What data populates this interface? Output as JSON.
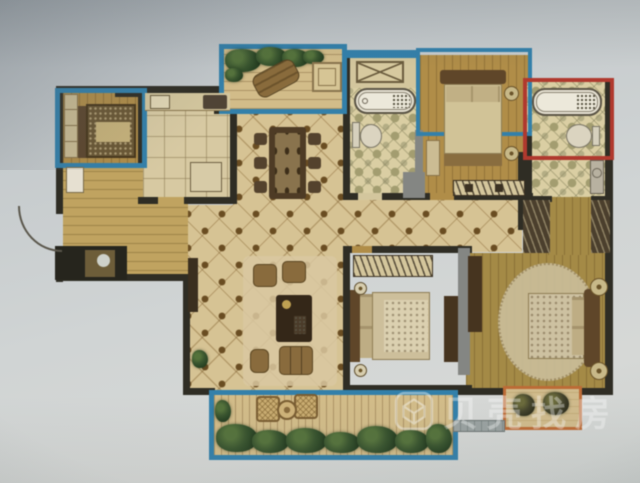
{
  "image": {
    "kind": "photograph of a printed apartment floor plan",
    "orientation": "plan occupies upper-right area of grey photo background"
  },
  "watermark": {
    "text": "贝壳找房",
    "logo_icon": "faceted-cube-in-rounded-square-logo"
  },
  "palette": {
    "wall": "#2d2b22",
    "gray": "#848683",
    "blue": "#2f81ad",
    "red": "#b5372b",
    "orange": "#c06a32",
    "tile": "#d9c492",
    "tileDot": "#6b4c1e",
    "mosaic": "#dcd0a2",
    "mosaicDot": "#a49e6e",
    "wood": "#b28d44",
    "master": "#a68a42",
    "kitchen": "#d9cba1",
    "hallWood": "#c2a45c",
    "balconyFloor": "#d5bd87",
    "furnBrown": "#8a6a3a",
    "furnDark": "#332515",
    "beige": "#d5c79c",
    "rug": "#dcc9a0",
    "plant": "#35522a",
    "white": "#e8e2d2"
  },
  "plan": {
    "highlights": [
      {
        "name": "blue-box-top-left-bedroom"
      },
      {
        "name": "blue-box-top-balcony"
      },
      {
        "name": "blue-box-top-right-bedroom-bay"
      },
      {
        "name": "blue-box-bottom-balcony"
      },
      {
        "name": "red-box-corner-bathroom"
      },
      {
        "name": "orange-box-master-bay-window"
      }
    ],
    "rooms": [
      {
        "name": "bedroom-top-left",
        "furniture": [
          "wardrobe",
          "double-bed"
        ]
      },
      {
        "name": "kitchen",
        "furniture": [
          "counter-with-sink",
          "stove",
          "fridge"
        ]
      },
      {
        "name": "top-balcony",
        "furniture": [
          "plants",
          "lounge-chair",
          "side-table"
        ]
      },
      {
        "name": "dining-area",
        "furniture": [
          "dining-table",
          "six-chairs"
        ]
      },
      {
        "name": "bathroom-middle",
        "furniture": [
          "washing-machine",
          "bathtub",
          "toilet"
        ]
      },
      {
        "name": "bedroom-top-right",
        "furniture": [
          "double-bed",
          "bench",
          "dresser"
        ]
      },
      {
        "name": "corner-bathroom-red",
        "furniture": [
          "bathtub",
          "toilet"
        ]
      },
      {
        "name": "utility-washroom",
        "furniture": [
          "sink-counter"
        ]
      },
      {
        "name": "living-room",
        "furniture": [
          "tv-console",
          "armchairs",
          "coffee-table",
          "sofa",
          "pouf",
          "rug",
          "plant"
        ]
      },
      {
        "name": "bedroom-middle",
        "furniture": [
          "wardrobe",
          "double-bed",
          "lamps",
          "dresser"
        ]
      },
      {
        "name": "master-bedroom",
        "furniture": [
          "walk-in-wardrobes",
          "double-bed",
          "oval-rug",
          "poufs",
          "tv-cabinet"
        ]
      },
      {
        "name": "bottom-balcony",
        "furniture": [
          "wicker-chairs",
          "round-table",
          "plants"
        ]
      },
      {
        "name": "entry",
        "furniture": [
          "door-swing-arc",
          "shoe-cabinet"
        ]
      }
    ]
  }
}
